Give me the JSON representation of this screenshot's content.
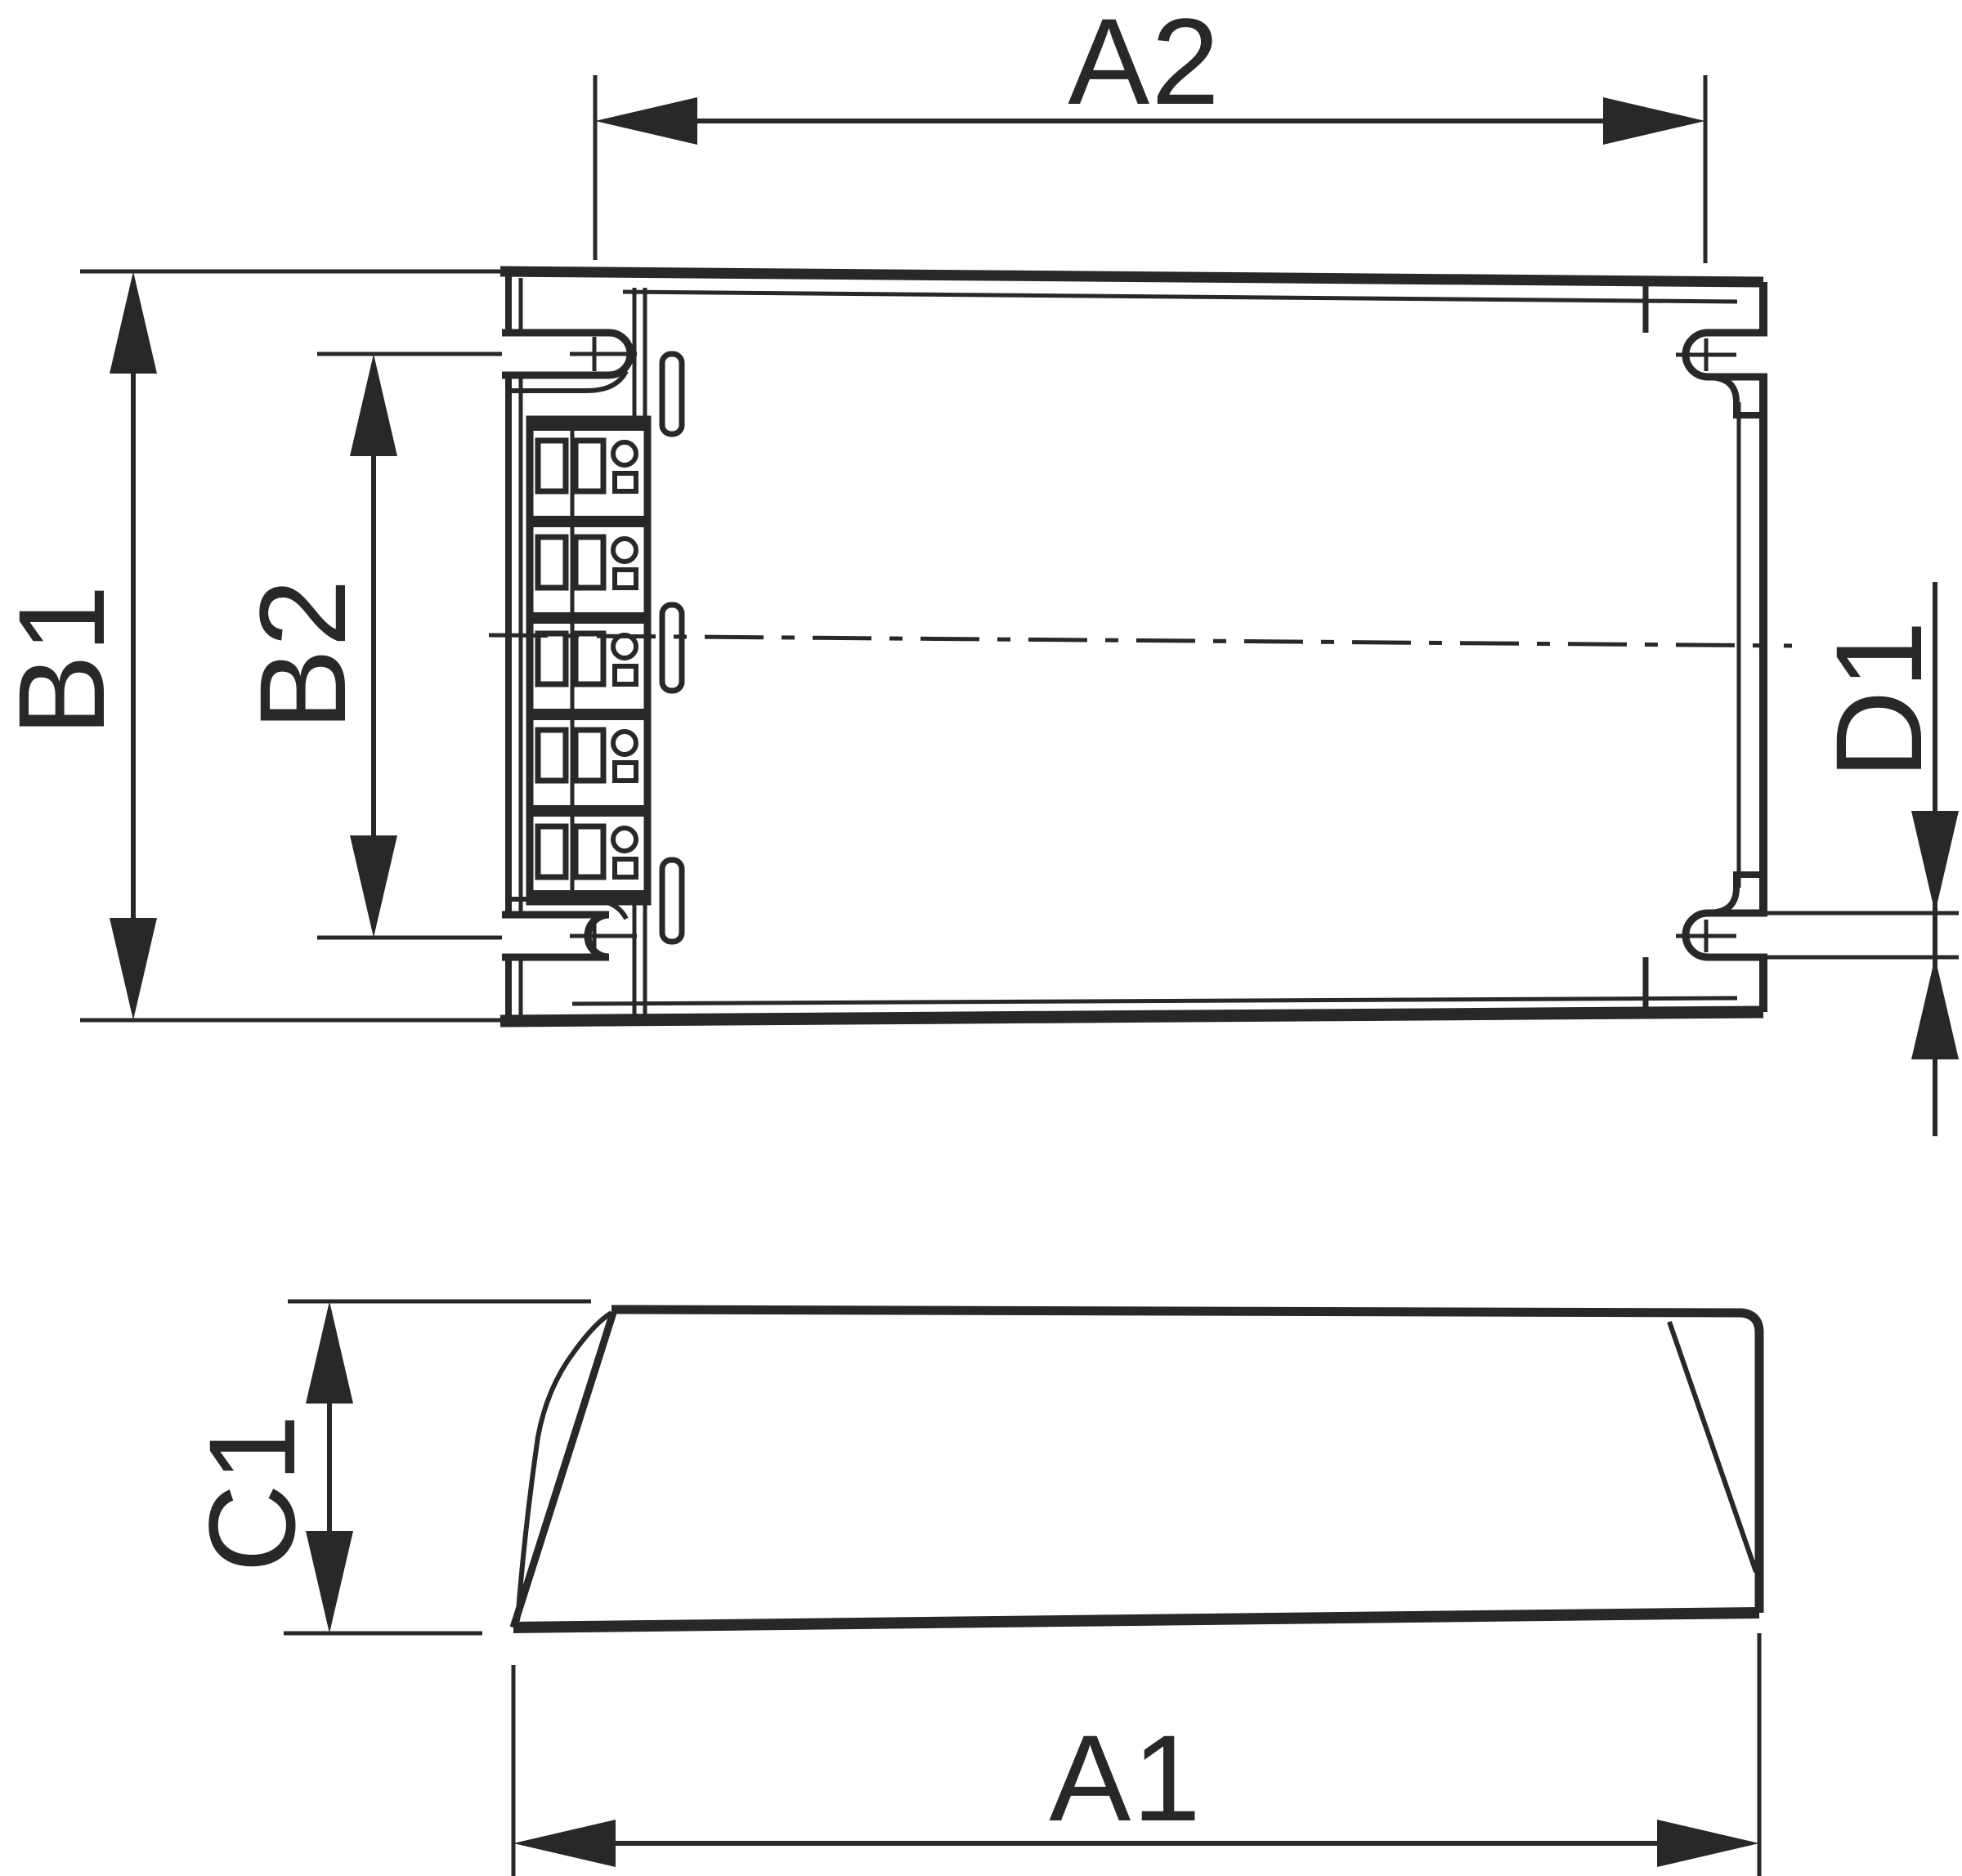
{
  "page": {
    "background": "#ffffff"
  },
  "style": {
    "line_color": "#2a2826"
  },
  "top_view": {
    "labels": {
      "a2": "A2",
      "b1": "B1",
      "b2": "B2",
      "d1": "D1"
    }
  },
  "side_view": {
    "labels": {
      "c1": "C1",
      "a1": "A1"
    }
  }
}
